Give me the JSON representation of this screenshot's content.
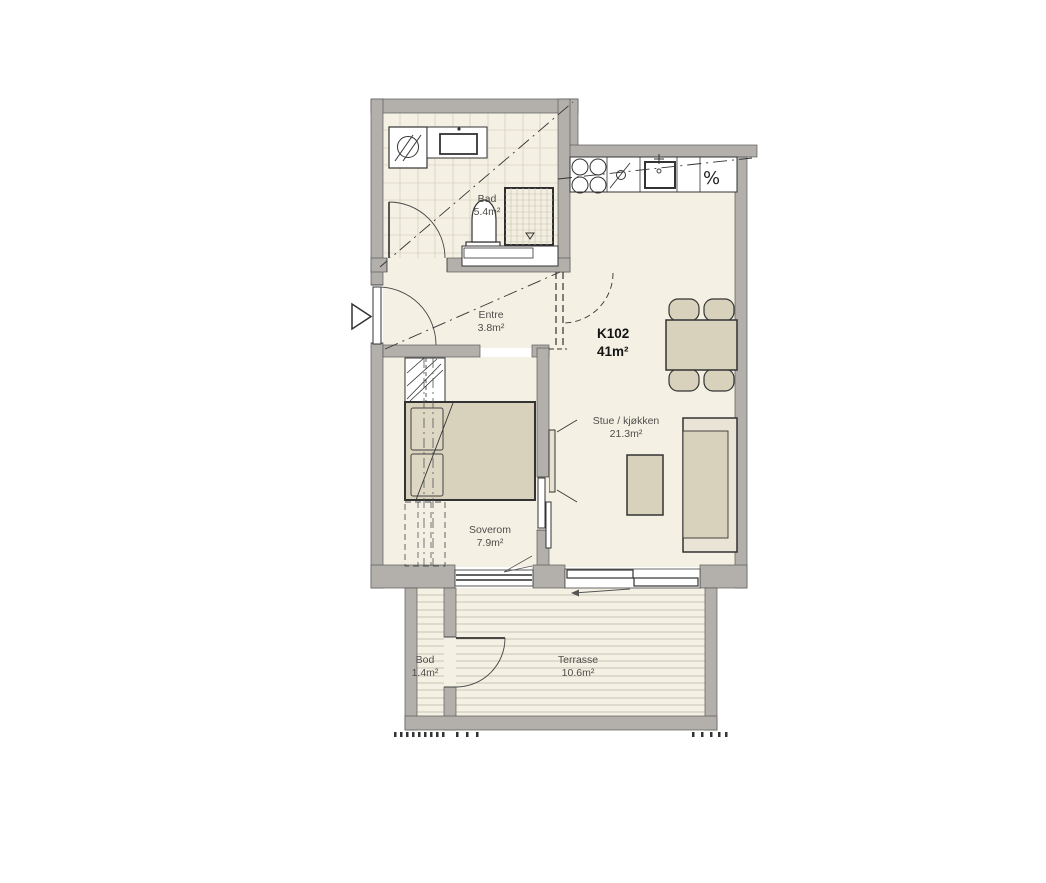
{
  "plan": {
    "unit": {
      "id": "K102",
      "area": "41m²"
    },
    "rooms": [
      {
        "name": "Bad",
        "area": "5.4m²"
      },
      {
        "name": "Entre",
        "area": "3.8m²"
      },
      {
        "name": "Stue / kjøkken",
        "area": "21.3m²"
      },
      {
        "name": "Soverom",
        "area": "7.9m²"
      },
      {
        "name": "Bod",
        "area": "1.4m²"
      },
      {
        "name": "Terrasse",
        "area": "10.6m²"
      }
    ],
    "kitchen": {
      "dishwasher_symbol": "%"
    },
    "colors": {
      "floor": "#f4f0e3",
      "wall": "#b3b0ab",
      "furniture": "#d8d1bb",
      "furniture_light": "#e9e4d5",
      "line": "#3f3f3f",
      "label_text": "#4f4e4c"
    }
  }
}
